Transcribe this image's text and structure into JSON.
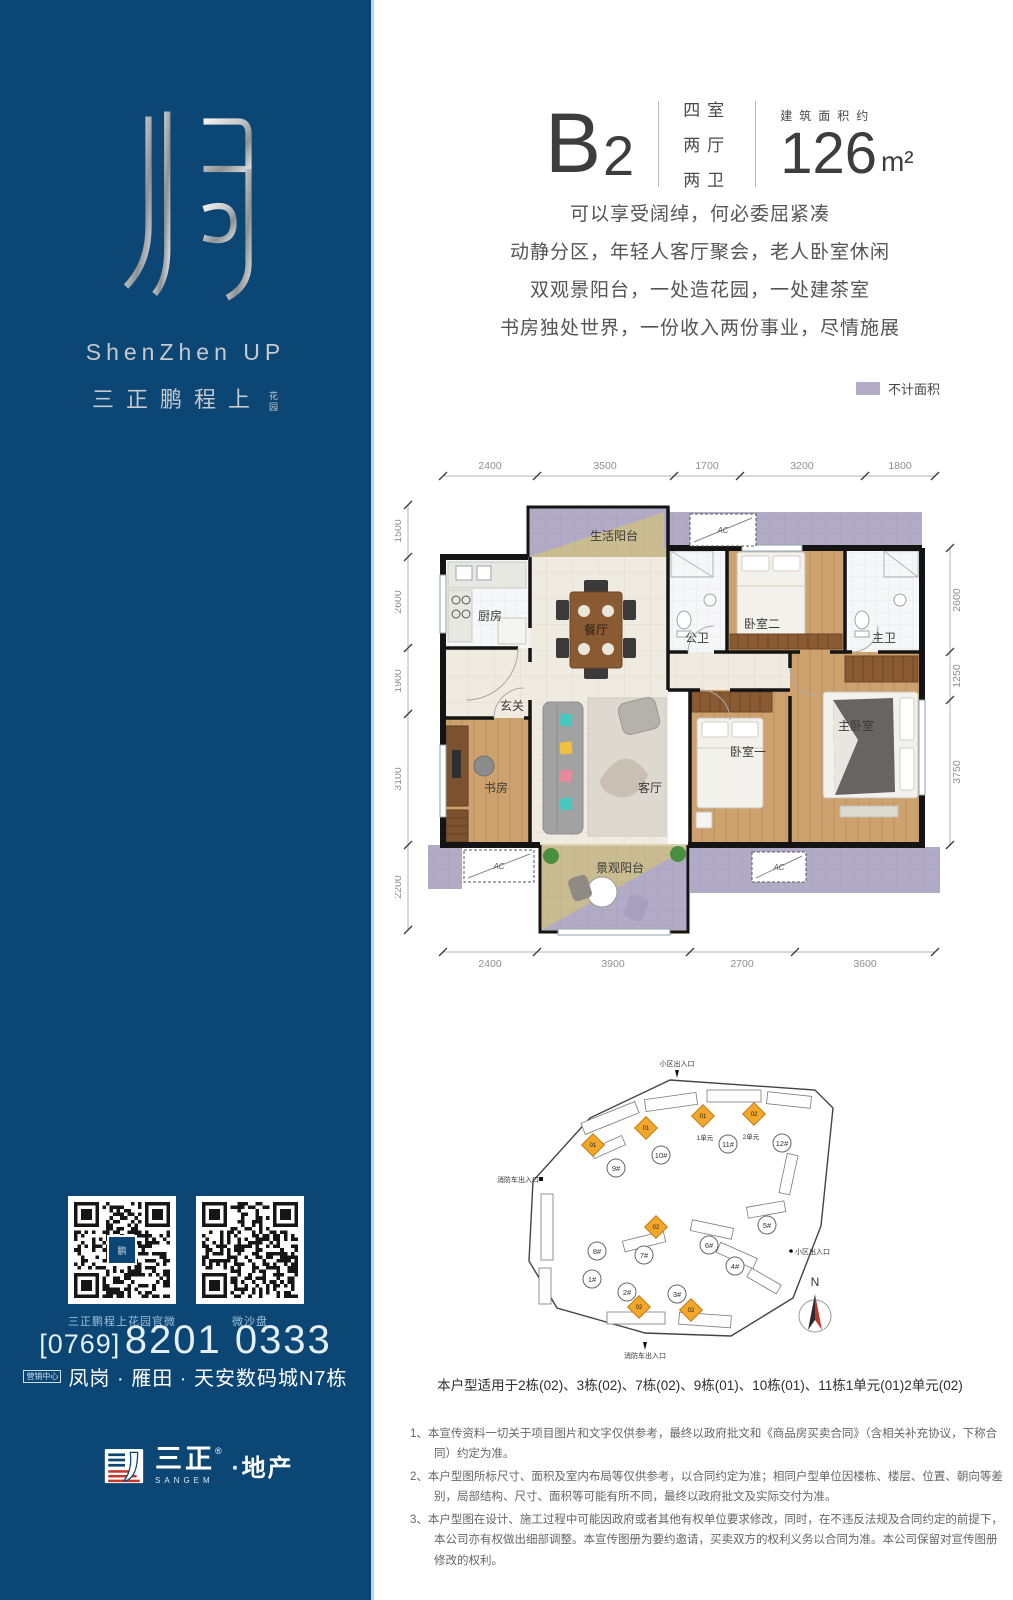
{
  "sidebar": {
    "brand_en": "ShenZhen UP",
    "brand_cn": "三正鹏程上",
    "brand_tag": "花园",
    "qr_left_label": "三正鹏程上花园官微",
    "qr_right_label": "微沙盘",
    "phone_area": "[0769]",
    "phone_number": "8201 0333",
    "marketing_badge": "营销中心",
    "address": "凤岗 · 雁田 · 天安数码城N7栋",
    "company_cn": "三正",
    "company_reg": "®",
    "company_suffix": "·地产",
    "company_en": "SANGEM"
  },
  "header": {
    "unit_letter": "B",
    "unit_digit": "2",
    "rooms": [
      "四室",
      "两厅",
      "两卫"
    ],
    "area_label": "建筑面积约",
    "area_value": "126",
    "area_unit": "m²"
  },
  "taglines": [
    "可以享受阔绰，何必委屈紧凑",
    "动静分区，年轻人客厅聚会，老人卧室休闲",
    "双观景阳台，一处造花园，一处建茶室",
    "书房独处世界，一份收入两份事业，尽情施展"
  ],
  "legend": {
    "label": "不计面积",
    "color": "#b2abc6"
  },
  "floorplan": {
    "dims_top": [
      "2400",
      "3500",
      "1700",
      "3200",
      "1800"
    ],
    "dims_bottom": [
      "2400",
      "3900",
      "2700",
      "3600"
    ],
    "dims_left": [
      "1500",
      "2600",
      "1900",
      "3100",
      "2200"
    ],
    "dims_right": [
      "2600",
      "1250",
      "3750"
    ],
    "rooms": {
      "life_balcony": "生活阳台",
      "kitchen": "厨房",
      "dining": "餐厅",
      "public_bath": "公卫",
      "bedroom2": "卧室二",
      "master_bath": "主卫",
      "foyer": "玄关",
      "study": "书房",
      "living": "客厅",
      "bedroom1": "卧室一",
      "master_bedroom": "主卧室",
      "view_balcony": "景观阳台"
    },
    "ac_label": "AC"
  },
  "siteplan": {
    "entrance_top": "小区出入口",
    "entrance_left": "消防车出入口",
    "entrance_right": "小区出入口",
    "entrance_bottom": "消防车出入口",
    "unit1_label": "1单元",
    "unit2_label": "2单元",
    "compass": "N",
    "buildings": [
      "1#",
      "2#",
      "3#",
      "4#",
      "5#",
      "6#",
      "7#",
      "8#",
      "9#",
      "10#",
      "11#",
      "12#"
    ],
    "highlights": [
      {
        "building": "9#",
        "unit": "01"
      },
      {
        "building": "10#",
        "unit": "01"
      },
      {
        "building": "11#",
        "unit": "01"
      },
      {
        "building": "11#",
        "unit": "02"
      },
      {
        "building": "7#",
        "unit": "02"
      },
      {
        "building": "2#",
        "unit": "02"
      },
      {
        "building": "3#",
        "unit": "02"
      }
    ]
  },
  "caption": "本户型适用于2栋(02)、3栋(02)、7栋(02)、9栋(01)、10栋(01)、11栋1单元(01)2单元(02)",
  "disclaimer": [
    "1、本宣传资料一切关于项目图片和文字仅供参考，最终以政府批文和《商品房买卖合同》（含相关补充协议，下称合同）约定为准。",
    "2、本户型图所标尺寸、面积及室内布局等仅供参考，以合同约定为准；相同户型单位因楼栋、楼层、位置、朝向等差别，局部结构、尺寸、面积等可能有所不同，最终以政府批文及实际交付为准。",
    "3、本户型图在设计、施工过程中可能因政府或者其他有权单位要求修改，同时，在不违反法规及合同约定的前提下，本公司亦有权做出细部调整。本宣传图册为要约邀请，买卖双方的权利义务以合同为准。本公司保留对宣传图册修改的权利。"
  ]
}
